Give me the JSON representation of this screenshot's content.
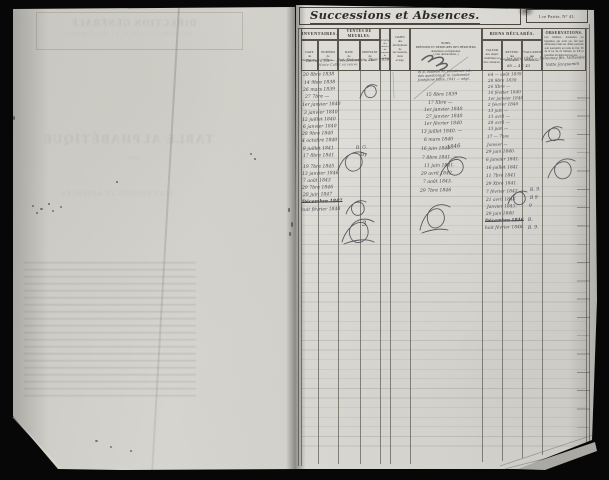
{
  "document": {
    "title": "Successions et Absences.",
    "corner_label": "1.re Partie, N° 41.",
    "header": {
      "inventaires": "INVENTAIRES.",
      "inv_date": "DATE\nde\nl'inventaire.",
      "inv_num": "NUMÉRO\nde\nl'article.",
      "ventes": "VENTES DE MEUBLES.",
      "vente_date": "DATE\nde\nl'enregistrement.",
      "vente_montant": "MONTANT\nde\nla vente.",
      "sommier": "NUMÉRO\ndes\narticles\ndu\nsommier\nde\nsurveillance.",
      "dates": "DATES\ndes\ndéclarations\nde\nsuccessions,\ndons\net legs.",
      "noms": "NOMS,\nPRÉNOMS ET DEMEURES DES HÉRITIERS,\ndonataires ou légataires.\n( voir déclarations. )",
      "biens": "BIENS DÉCLARÉS.",
      "biens_valeur": "VALEUR\ndes objets\nmobiliers et\ndes créances.",
      "biens_revenu": "REVENU\ndes\nimmeubles.",
      "biens_eval": "ÉVALUATION\ndes\nimmeubles.",
      "observations": "OBSERVATIONS.",
      "observations_note": "Les héritiers, donataires ou légataires qui n'ont pas fait leur déclaration dans les délais prescrits sont poursuivis en vertu de l'art. 39 de la loi du 22 frimaire an VII et passibles du demi-droit en sus."
    }
  },
  "bleedthrough": [
    {
      "t": "DIRECTION GÉNÉRALE",
      "x": 70,
      "y": 18,
      "s": 9,
      "ls": 1.2,
      "o": 0.2,
      "w": 700,
      "r": 0
    },
    {
      "t": "DE L'ENREGISTREMENT ET DES DOMAINES",
      "x": 62,
      "y": 32,
      "s": 5,
      "ls": 0.8,
      "o": 0.16,
      "r": 0
    },
    {
      "t": "TABLE ALPHABÉTIQUE",
      "x": 42,
      "y": 132,
      "s": 12.5,
      "ls": 1.5,
      "o": 0.17,
      "w": 700,
      "r": 0
    },
    {
      "t": "DES",
      "x": 128,
      "y": 156,
      "s": 6,
      "o": 0.13,
      "r": 0
    },
    {
      "t": "SUCCESSIONS ET ABSENCES.",
      "x": 58,
      "y": 190,
      "s": 7,
      "ls": 0.8,
      "o": 0.16,
      "r": 0
    }
  ],
  "handwriting": {
    "row1": [
      {
        "t": "Bernard fils — Not. Delacroix, 7bre 1838",
        "x": 306,
        "y": 58,
        "s": 4,
        "r": -1
      },
      {
        "t": "Marie Collet sa veuve",
        "x": 318,
        "y": 63,
        "s": 3.6,
        "r": -1,
        "o": 0.8
      },
      {
        "t": "68 — 4 f. 43",
        "x": 507,
        "y": 63,
        "s": 3.8,
        "r": 0
      },
      {
        "t": "au 1er janv. 1843 — Delaunay fils, Vatteville",
        "x": 500,
        "y": 56,
        "s": 3.8,
        "r": -1
      },
      {
        "t": "Vatte Jacquemin",
        "x": 546,
        "y": 62,
        "s": 4,
        "r": -2
      }
    ],
    "col1": [
      {
        "t": "20 8bre 1838",
        "x": 303,
        "y": 73
      },
      {
        "t": "14 9bre 1838",
        "x": 304,
        "y": 81
      },
      {
        "t": "26 mars 1839",
        "x": 303,
        "y": 88
      },
      {
        "t": "27 7bre —",
        "x": 305,
        "y": 95
      },
      {
        "t": "1er janvier 1840",
        "x": 302,
        "y": 103
      },
      {
        "t": "3 janvier 1840",
        "x": 304,
        "y": 111
      },
      {
        "t": "12 juillet 1840",
        "x": 302,
        "y": 118
      },
      {
        "t": "6 janvier 1840",
        "x": 303,
        "y": 125
      },
      {
        "t": "28 9bre 1840",
        "x": 302,
        "y": 132
      },
      {
        "t": "4 octobre 1840",
        "x": 302,
        "y": 139
      },
      {
        "t": "8 juillet 1841",
        "x": 303,
        "y": 147
      },
      {
        "t": "17 8bre 1841",
        "x": 303,
        "y": 154
      },
      {
        "t": "19 7bre 1845",
        "x": 303,
        "y": 165
      },
      {
        "t": "13 janvier 1846",
        "x": 302,
        "y": 172
      },
      {
        "t": "7 août 1843",
        "x": 303,
        "y": 179
      },
      {
        "t": "29 7bre 1846",
        "x": 302,
        "y": 186
      },
      {
        "t": "28 juin 1847",
        "x": 303,
        "y": 193
      },
      {
        "t": "Décembre 1847",
        "x": 302,
        "y": 200,
        "st": true,
        "w": 700
      },
      {
        "t": "huit février 1848",
        "x": 301,
        "y": 208
      }
    ],
    "col45": [
      {
        "t": "et p. Isabelle M. constituée int.",
        "x": 418,
        "y": 70,
        "s": 3.4
      },
      {
        "t": "des questions p. m. indemnité",
        "x": 418,
        "y": 74,
        "s": 3.4
      },
      {
        "t": "Joséphine Vatte, 1841 — négt.",
        "x": 418,
        "y": 78,
        "s": 3.4
      },
      {
        "t": "15 8bre 1839",
        "x": 426,
        "y": 93
      },
      {
        "t": "17 Xbre —",
        "x": 428,
        "y": 101
      },
      {
        "t": "1er janvier 1840",
        "x": 424,
        "y": 108
      },
      {
        "t": "27 janvier 1840",
        "x": 426,
        "y": 115
      },
      {
        "t": "1er février 1840",
        "x": 424,
        "y": 122
      },
      {
        "t": "13 juillet 1840. —",
        "x": 421,
        "y": 130
      },
      {
        "t": "6 mars 1840",
        "x": 424,
        "y": 138
      },
      {
        "t": "16 juin 1840",
        "x": 421,
        "y": 147
      },
      {
        "t": "1846",
        "x": 447,
        "y": 145,
        "s": 5.4,
        "r": -8
      },
      {
        "t": "7 8bre 1841. —",
        "x": 422,
        "y": 156
      },
      {
        "t": "11 juin 1841.",
        "x": 424,
        "y": 164
      },
      {
        "t": "29 avril 1842",
        "x": 421,
        "y": 172
      },
      {
        "t": "7 août 1843.",
        "x": 423,
        "y": 180
      },
      {
        "t": "29 7bre 1846",
        "x": 420,
        "y": 189
      },
      {
        "t": "3",
        "x": 362,
        "y": 220,
        "s": 7,
        "r": -6
      }
    ],
    "col6": [
      {
        "t": "64 — août 1839",
        "x": 488,
        "y": 72,
        "s": 4.2
      },
      {
        "t": "28 9bre 1839",
        "x": 488,
        "y": 78,
        "s": 4.2
      },
      {
        "t": "26 Xbre —",
        "x": 488,
        "y": 84,
        "s": 4.2
      },
      {
        "t": "10 février 1840",
        "x": 488,
        "y": 90,
        "s": 4.2
      },
      {
        "t": "1er janvier 1840",
        "x": 488,
        "y": 96,
        "s": 4.2
      },
      {
        "t": "2 février 1840",
        "x": 488,
        "y": 102,
        "s": 4.2
      },
      {
        "t": "13 juin —",
        "x": 488,
        "y": 108,
        "s": 4.2
      },
      {
        "t": "13 avril —",
        "x": 488,
        "y": 114,
        "s": 4.2
      },
      {
        "t": "28 avril —",
        "x": 488,
        "y": 120,
        "s": 4.2
      },
      {
        "t": "13 juin —",
        "x": 488,
        "y": 126,
        "s": 4.2
      },
      {
        "t": "17 — 7bre",
        "x": 487,
        "y": 134,
        "s": 4.2
      },
      {
        "t": "Janvier —",
        "x": 487,
        "y": 142,
        "s": 4.2
      },
      {
        "t": "29 juin 1840.",
        "x": 486,
        "y": 150,
        "s": 4.4
      },
      {
        "t": "6 janvier 1841.",
        "x": 486,
        "y": 158,
        "s": 4.4
      },
      {
        "t": "16 juillet 1841",
        "x": 486,
        "y": 166,
        "s": 4.4
      },
      {
        "t": "11 7bre 1841",
        "x": 486,
        "y": 174,
        "s": 4.4
      },
      {
        "t": "29 Xbre 1841.",
        "x": 486,
        "y": 182,
        "s": 4.4
      },
      {
        "t": "7 février 1842",
        "x": 486,
        "y": 190,
        "s": 4.4
      },
      {
        "t": "21 avril 1843",
        "x": 486,
        "y": 198,
        "s": 4.4
      },
      {
        "t": "Janvier 1843.",
        "x": 487,
        "y": 205,
        "s": 4.4
      },
      {
        "t": "29 juin 1840",
        "x": 486,
        "y": 212,
        "s": 4.4
      },
      {
        "t": "Décembre 1846",
        "x": 485,
        "y": 219,
        "s": 4.4,
        "st": true,
        "w": 700
      },
      {
        "t": "huit février 1848.",
        "x": 485,
        "y": 226,
        "s": 4.4
      }
    ],
    "marks": [
      {
        "t": "B. G.",
        "x": 356,
        "y": 146,
        "s": 4.6,
        "r": -4
      },
      {
        "t": "By",
        "x": 361,
        "y": 153,
        "s": 4.6,
        "r": -6
      },
      {
        "t": "B. 9.",
        "x": 530,
        "y": 188,
        "s": 4.6,
        "r": -4
      },
      {
        "t": "B 9",
        "x": 530,
        "y": 196,
        "s": 4.6,
        "r": -4
      },
      {
        "t": "9",
        "x": 529,
        "y": 204,
        "s": 4.6,
        "r": -4
      },
      {
        "t": "B.",
        "x": 528,
        "y": 218,
        "s": 4.6,
        "r": -4
      },
      {
        "t": "B. 9.",
        "x": 528,
        "y": 226,
        "s": 4.6,
        "r": -4
      }
    ]
  }
}
